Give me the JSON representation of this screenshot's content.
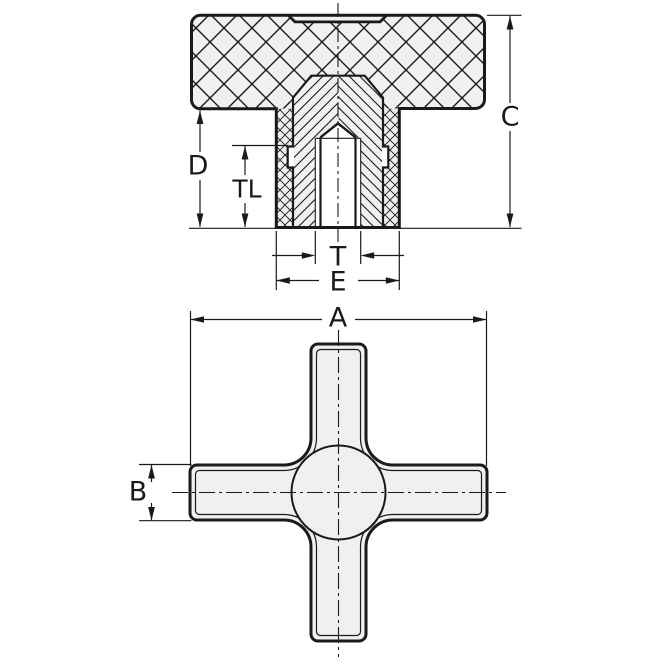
{
  "dimensions": {
    "section": {
      "overall_height": "C",
      "hub_depth": "D",
      "thread_length": "TL",
      "thread": "T",
      "hub_diameter": "E"
    },
    "plan": {
      "overall_width": "A",
      "arm_thickness": "B"
    }
  },
  "colors": {
    "line": "#1a1a1a",
    "part_fill": "#f0f0f0",
    "background": "#ffffff"
  }
}
